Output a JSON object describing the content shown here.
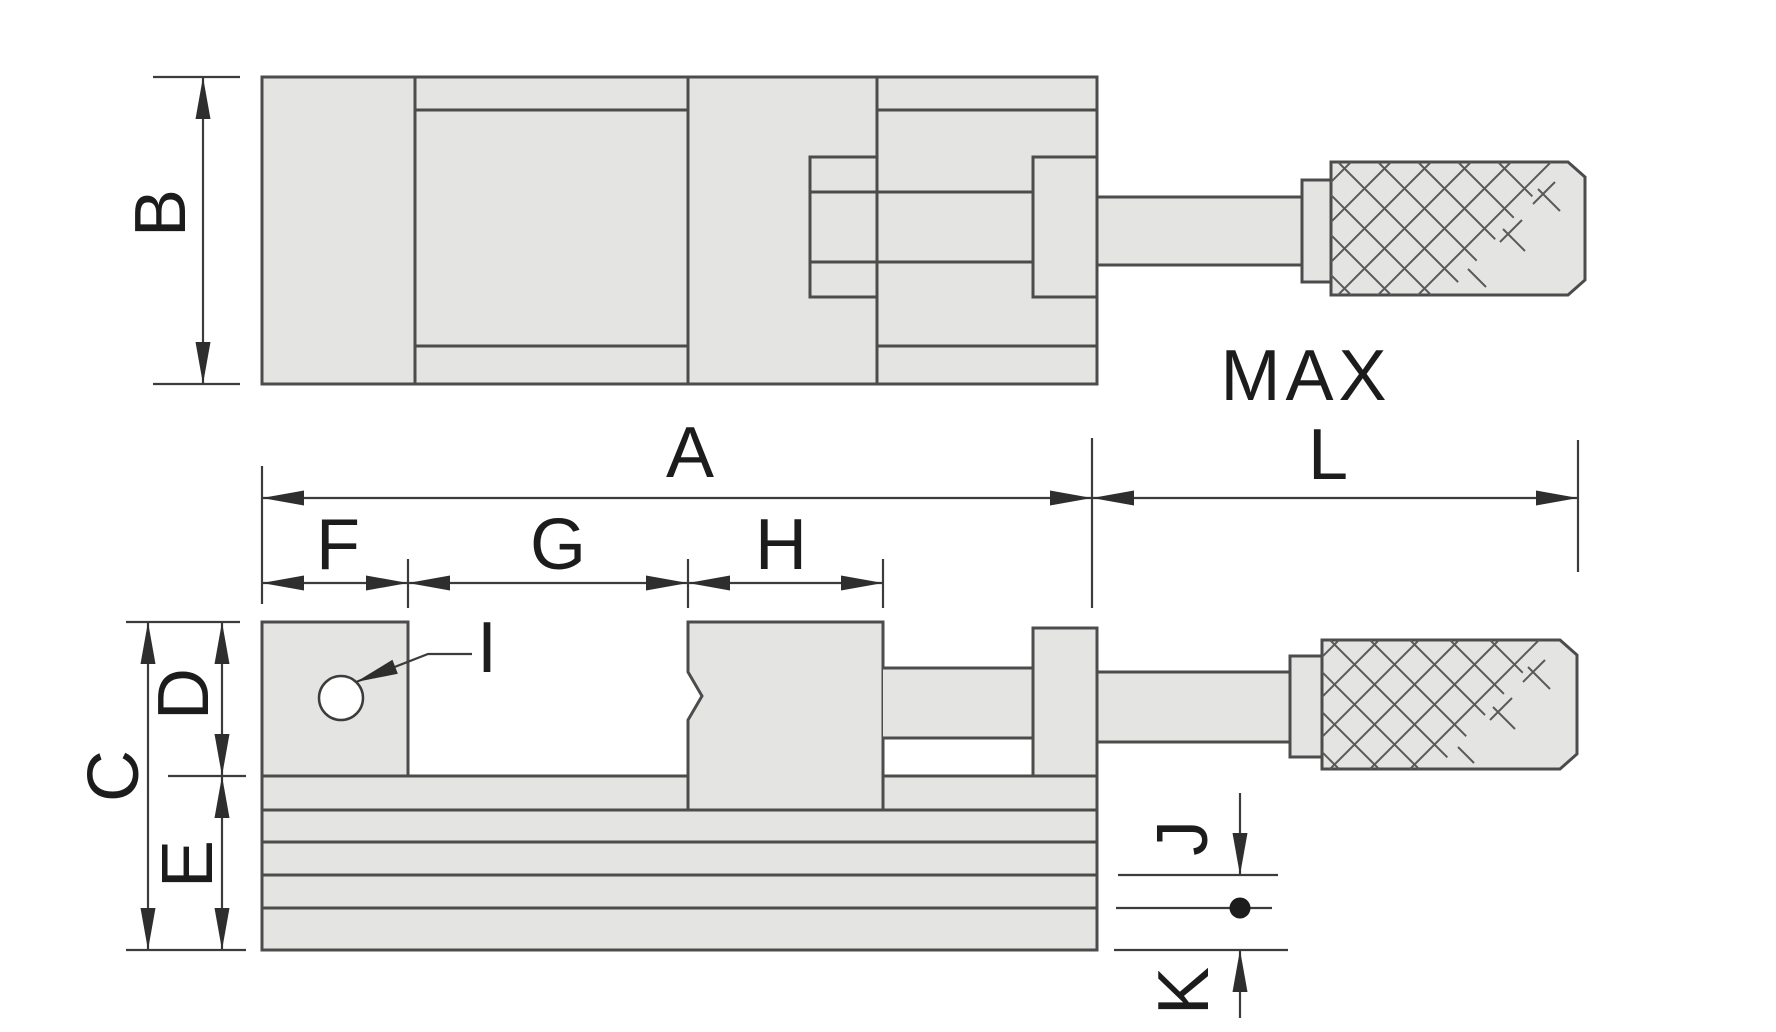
{
  "labels": {
    "a": "A",
    "b": "B",
    "c": "C",
    "d": "D",
    "e": "E",
    "f": "F",
    "g": "G",
    "h": "H",
    "i": "I",
    "j": "J",
    "k": "K",
    "max": "MAX",
    "l": "L"
  },
  "colors": {
    "background": "#ffffff",
    "part_fill": "#e4e4e2",
    "part_outline": "#4c4c4c",
    "dimension_line": "#3c3c3c",
    "label_text": "#1c1c1c"
  }
}
